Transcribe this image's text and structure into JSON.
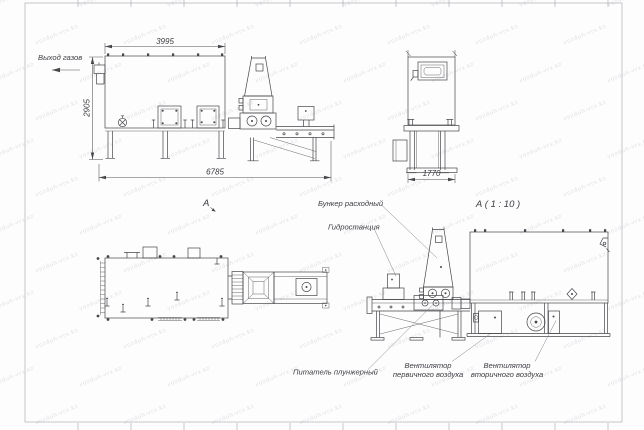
{
  "sheet": {
    "watermark_text": "vozduh-vrv.kz",
    "colors": {
      "ink": "#46464b",
      "watermark": "#c5c7ce",
      "frame": "#a2a6ac"
    }
  },
  "side_view": {
    "marker": "А",
    "gas_outlet_label": "Выход газов",
    "dim_top": "3995",
    "dim_height": "2905",
    "dim_total": "6785"
  },
  "end_view": {
    "dim_width": "1770"
  },
  "detail_view": {
    "title": "А ( 1 : 10 )",
    "label_feed_hopper": "Бункер расходный",
    "label_hydraulic_station": "Гидростанция",
    "label_plunger_feeder": "Питатель плунжерный",
    "label_primary_fan_line1": "Вентилятор",
    "label_primary_fan_line2": "первичного воздуха",
    "label_secondary_fan_line1": "Вентилятор",
    "label_secondary_fan_line2": "вторичного воздуха"
  }
}
